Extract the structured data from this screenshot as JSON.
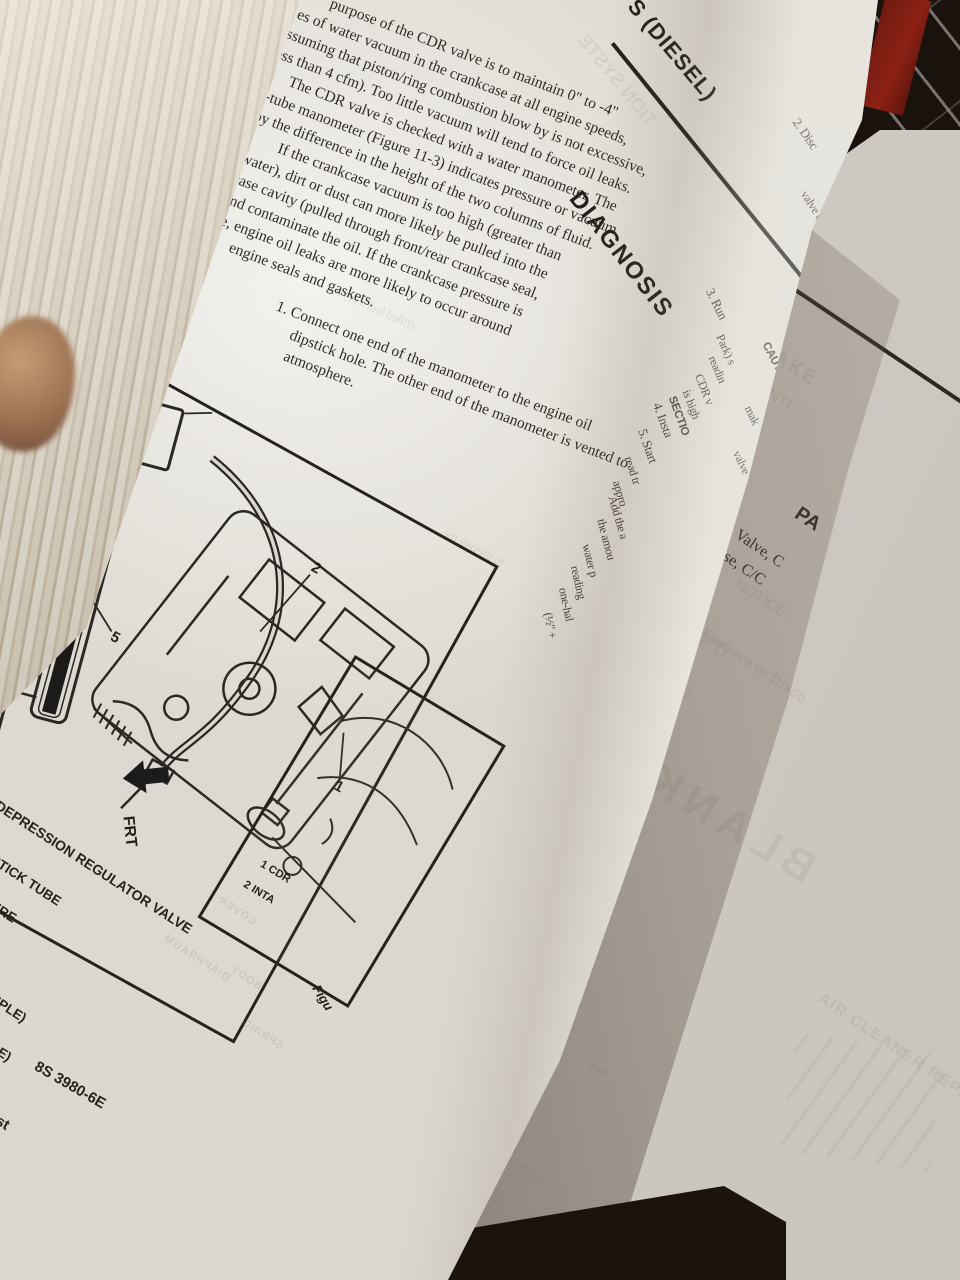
{
  "colors": {
    "paper": "#dcd8d1",
    "ink": "#2e2a25",
    "crate_red": "#7d1d13",
    "table_dark": "#241b12",
    "skin": "#b08a69"
  },
  "book": {
    "left_page": {
      "header_partial": "S (DIESEL)",
      "diagnosis_heading": "DIAGNOSIS",
      "ghost_header": "TION SYSTE",
      "para_lines": [
        "purpose of the CDR valve is to maintain 0\" to -4\"",
        "es of water vacuum in the crankcase at all engine speeds,",
        "assuming that piston/ring combustion blow by is not excessive,",
        "(less than 4 cfm). Too little vacuum will tend to force oil leaks.",
        "The CDR valve is checked with a water manometer. The",
        "U-tube manometer (Figure 11-3) indicates pressure or vacuum",
        "by the difference in the height of the two columns of fluid.",
        "If the crankcase vacuum is too high (greater than",
        "-4\" water), dirt or dust can more likely be pulled into the",
        "crankcase cavity (pulled through front/rear crankcase seal,",
        "etc...) and contaminate the oil. If the crankcase pressure is",
        "positive, engine oil leaks are more likely to occur around",
        "engine seals and gaskets."
      ],
      "item1_lines": [
        "1.   Connect one end of the manometer to the engine oil",
        "dipstick hole. The other end of the manometer is vented to",
        "atmosphere."
      ],
      "ghost_lines": [
        "(filled halfway) le",
        "to prevent the"
      ],
      "spine_fragments": [
        "2.  Disc",
        "valve c",
        "CAUTI",
        "mak",
        "valve",
        "3.  Run",
        "Park) s",
        "readin",
        "CDR v",
        "is high",
        "SECTIO",
        "4.  Insta",
        "5.  Start",
        "read tr",
        "appro",
        "Add the a",
        "the amou",
        "water p",
        "reading",
        "one-hal",
        "(½\" +"
      ]
    },
    "figure_11_3": {
      "scale_labels": [
        "3",
        "2",
        "1",
        "0",
        "1",
        "2",
        "3"
      ],
      "callouts": [
        "1",
        "2",
        "3",
        "4",
        "5",
        "6"
      ],
      "frt_label": "FRT",
      "legend_lines": [
        "E DEPRESSION REGULATOR VALVE",
        "STICK TUBE",
        "ERE",
        "MPLE)",
        "LE)"
      ],
      "part_number": "8S 3980-6E",
      "corner_fragment": "est",
      "ghost_labels": [
        "COVER",
        "DIAPHRAGM",
        "BODY",
        "SPRING"
      ]
    },
    "figure_partial": {
      "legend_lines": [
        "1  CDR",
        "2  INTA"
      ],
      "caption_fragment": "Figu"
    },
    "right_page": {
      "header_partial": "ON-VEHICL",
      "body_fragments": [
        "ow any solvent to come in",
        "of the crankcase depression",
        "e diaphragm will fail.",
        "gulator valve is replaced as an",
        "quired, if inspection indicates",
        "ppropriate service manual for",
        "em maintenance requirements."
      ],
      "parts_heading_partial": "PA",
      "parts_lines": [
        "Valve, C",
        "Hose, C/C"
      ],
      "ghosts": [
        "AIR INTAKE",
        "CONTI",
        "DESCRIPTI",
        "NOTICE:",
        "Remove or Disco",
        "Figure 12-1",
        "Inspect",
        "Install or A",
        "Figure 12-",
        "AIR CLEANER REPL",
        "BLANK"
      ]
    },
    "curl_back_ghosts": [
      "E SERVICE",
      "cleaner",
      "the engine",
      "starting the",
      "Also take",
      "removed",
      "clamp",
      "fire"
    ]
  }
}
